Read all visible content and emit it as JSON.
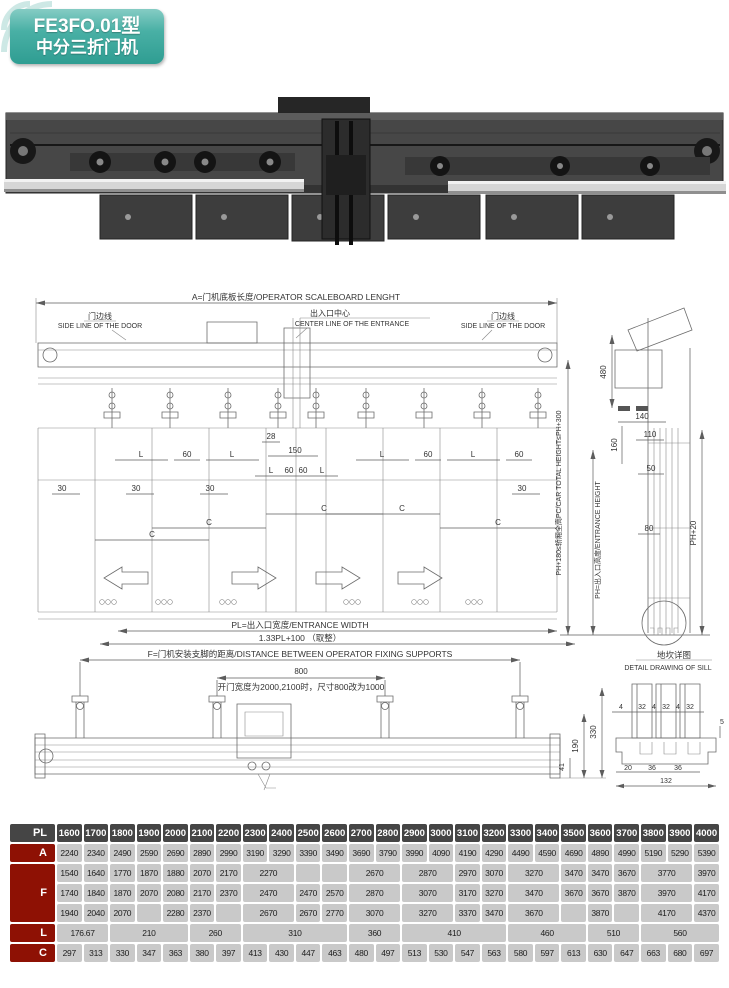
{
  "badge": {
    "model": "FE3FO.01型",
    "name": "中分三折门机"
  },
  "elevation": {
    "dim_a": "A=门机底板长度/OPERATOR  SCALEBOARD  LENGHT",
    "side_line_cn": "门边线",
    "side_line_en": "SIDE LINE OF THE DOOR",
    "center_line_cn": "出入口中心",
    "center_line_en": "CENTER LINE OF THE ENTRANCE",
    "d28": "28",
    "d150": "150",
    "dL": "L",
    "d60": "60",
    "d30": "30",
    "dC": "C",
    "pl_label": "PL=出入口宽度/ENTRANCE WIDTH",
    "pl_formula": "1.33PL+100 （取整）"
  },
  "section": {
    "d480": "480",
    "d140": "140",
    "d160": "160",
    "d110": "110",
    "d50": "50",
    "d80": "80",
    "ph20": "PH+20",
    "car_total_height": "PH+180≤轿厢全高PC/CAR  TOTAL  HEIGHT≤PH+300",
    "entrance_height": "PH=出入口高度/ENTRANCE  HEIGHT"
  },
  "fixing": {
    "dim_f": "F=门机安装支脚的距离/DISTANCE  BETWEEN  OPERATOR  FIXING  SUPPORTS",
    "d800": "800",
    "note": "开门宽度为2000,2100时，尺寸800改为1000",
    "d330": "330",
    "d190": "190",
    "d41": "41"
  },
  "sill": {
    "title_cn": "地坎详图",
    "title_en": "DETAIL DRAWING OF SILL",
    "d4": "4",
    "d32": "32",
    "d5": "5",
    "d20": "20",
    "d36": "36",
    "d132": "132"
  },
  "table": {
    "corner": "PL",
    "columns": [
      "1600",
      "1700",
      "1800",
      "1900",
      "2000",
      "2100",
      "2200",
      "2300",
      "2400",
      "2500",
      "2600",
      "2700",
      "2800",
      "2900",
      "3000",
      "3100",
      "3200",
      "3300",
      "3400",
      "3500",
      "3600",
      "3700",
      "3800",
      "3900",
      "4000"
    ],
    "groups": [
      {
        "label": "A",
        "rows": [
          [
            [
              "2240"
            ],
            [
              "2340"
            ],
            [
              "2490"
            ],
            [
              "2590"
            ],
            [
              "2690"
            ],
            [
              "2890"
            ],
            [
              "2990"
            ],
            [
              "3190"
            ],
            [
              "3290"
            ],
            [
              "3390"
            ],
            [
              "3490"
            ],
            [
              "3690"
            ],
            [
              "3790"
            ],
            [
              "3990"
            ],
            [
              "4090"
            ],
            [
              "4190"
            ],
            [
              "4290"
            ],
            [
              "4490"
            ],
            [
              "4590"
            ],
            [
              "4690"
            ],
            [
              "4890"
            ],
            [
              "4990"
            ],
            [
              "5190"
            ],
            [
              "5290"
            ],
            [
              "5390"
            ]
          ]
        ]
      },
      {
        "label": "F",
        "rows": [
          [
            [
              "1540"
            ],
            [
              "1640"
            ],
            [
              "1770"
            ],
            [
              "1870"
            ],
            [
              "1880"
            ],
            [
              "2070"
            ],
            [
              "2170"
            ],
            [
              "2270",
              2
            ],
            [
              ""
            ],
            [
              ""
            ],
            [
              "2670",
              2
            ],
            [
              "2870",
              2
            ],
            [
              "2970"
            ],
            [
              "3070"
            ],
            [
              "3270",
              2
            ],
            [
              "3470"
            ],
            [
              "3470"
            ],
            [
              "3670"
            ],
            [
              "3770",
              2
            ],
            [
              "3970"
            ]
          ],
          [
            [
              "1740"
            ],
            [
              "1840"
            ],
            [
              "1870"
            ],
            [
              "2070"
            ],
            [
              "2080"
            ],
            [
              "2170"
            ],
            [
              "2370"
            ],
            [
              "2470",
              2
            ],
            [
              "2470"
            ],
            [
              "2570"
            ],
            [
              "2870",
              2
            ],
            [
              "3070",
              2
            ],
            [
              "3170"
            ],
            [
              "3270"
            ],
            [
              "3470",
              2
            ],
            [
              "3670"
            ],
            [
              "3670"
            ],
            [
              "3870"
            ],
            [
              "3970",
              2
            ],
            [
              "4170"
            ]
          ],
          [
            [
              "1940"
            ],
            [
              "2040"
            ],
            [
              "2070"
            ],
            [
              ""
            ],
            [
              "2280"
            ],
            [
              "2370"
            ],
            [
              ""
            ],
            [
              "2670",
              2
            ],
            [
              "2670"
            ],
            [
              "2770"
            ],
            [
              "3070",
              2
            ],
            [
              "3270",
              2
            ],
            [
              "3370"
            ],
            [
              "3470"
            ],
            [
              "3670",
              2
            ],
            [
              ""
            ],
            [
              "3870"
            ],
            [
              ""
            ],
            [
              "4170",
              2
            ],
            [
              "4370"
            ]
          ]
        ]
      },
      {
        "label": "L",
        "rows": [
          [
            [
              "176.67",
              2
            ],
            [
              "210",
              3
            ],
            [
              "260",
              2
            ],
            [
              "310",
              4
            ],
            [
              "360",
              2
            ],
            [
              "410",
              4
            ],
            [
              "460",
              3
            ],
            [
              "510",
              2
            ],
            [
              "560",
              3
            ]
          ]
        ]
      },
      {
        "label": "C",
        "rows": [
          [
            [
              "297"
            ],
            [
              "313"
            ],
            [
              "330"
            ],
            [
              "347"
            ],
            [
              "363"
            ],
            [
              "380"
            ],
            [
              "397"
            ],
            [
              "413"
            ],
            [
              "430"
            ],
            [
              "447"
            ],
            [
              "463"
            ],
            [
              "480"
            ],
            [
              "497"
            ],
            [
              "513"
            ],
            [
              "530"
            ],
            [
              "547"
            ],
            [
              "563"
            ],
            [
              "580"
            ],
            [
              "597"
            ],
            [
              "613"
            ],
            [
              "630"
            ],
            [
              "647"
            ],
            [
              "663"
            ],
            [
              "680"
            ],
            [
              "697"
            ]
          ]
        ]
      }
    ]
  }
}
